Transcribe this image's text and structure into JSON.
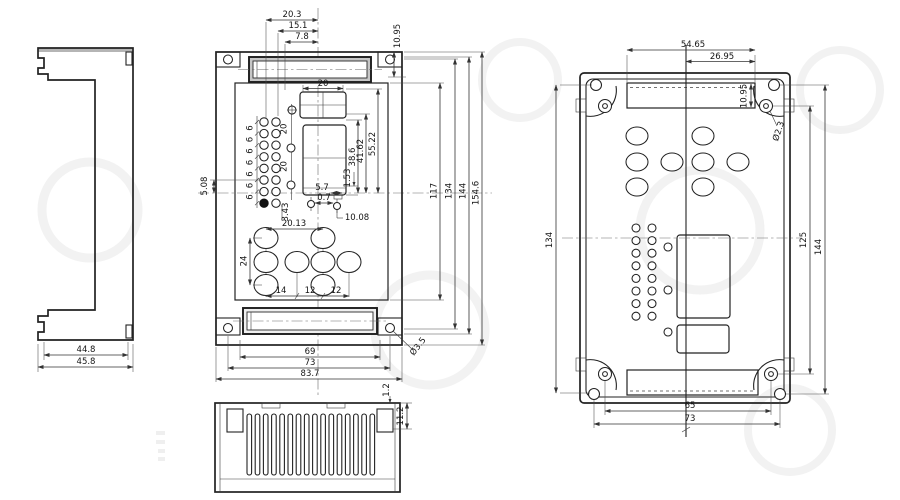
{
  "palette": {
    "line": "#222222",
    "dimension": "#333333",
    "centerline": "#6a6a6a",
    "background": "#ffffff",
    "slot_shade": "#c6c6c6",
    "watermark": "#d9d9d9"
  },
  "views": {
    "side_profile": {
      "dims": {
        "inner_width": "44.8",
        "outer_width": "45.8"
      }
    },
    "front": {
      "dims": {
        "top_w1": "20.3",
        "top_w2": "15.1",
        "top_w3": "7.8",
        "top_right_h": "10.95",
        "slot_w": "20",
        "hole_pitch_v": "20",
        "hole_pitch_small": "6",
        "left_offset": "5.08",
        "left_offset2": "3.43",
        "right_h1": "55.22",
        "right_h2": "41.62",
        "right_h3": "38.6",
        "right_h4": "1.53",
        "mid_w1": "5.7",
        "mid_w2": "0.7",
        "mid_w3": "10.08",
        "low_w1": "20.13",
        "low_h": "24",
        "low_p1": "14",
        "low_p2": "12",
        "bot_w1": "69",
        "bot_w2": "73",
        "bot_w3": "83.7",
        "corner_hole": "Ø3.5",
        "side_h1": "117",
        "side_h2": "134",
        "side_h3": "144",
        "side_h4": "154.6"
      }
    },
    "bottom_fins": {
      "dims": {
        "wall_t": "1.2",
        "post_h": "11.2"
      }
    },
    "back": {
      "dims": {
        "top_w1": "54.65",
        "top_w2": "26.95",
        "slot_h": "10.95",
        "corner_hole": "Ø2.3",
        "left_h": "134",
        "right_h1": "125",
        "right_h2": "144",
        "bot_w1": "65",
        "bot_w2": "73"
      }
    }
  }
}
